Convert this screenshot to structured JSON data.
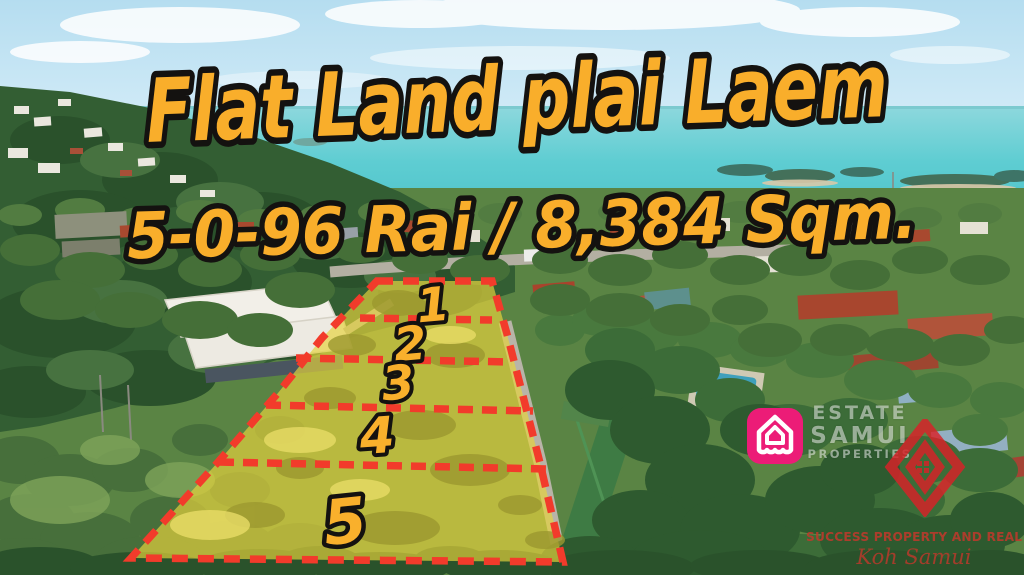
{
  "banner": {
    "title": "Flat Land plai Laem",
    "subtitle": "5-0-96 Rai / 8,384 Sqm."
  },
  "plots": [
    {
      "label": "1"
    },
    {
      "label": "2"
    },
    {
      "label": "3"
    },
    {
      "label": "4"
    },
    {
      "label": "5"
    }
  ],
  "watermark": {
    "line1": "ESTATE",
    "line2": "SAMUI",
    "line3": "PROPERTIES"
  },
  "agency": {
    "name": "SUCCESS PROPERTY AND REAL ESTATE",
    "location": "Koh Samui"
  },
  "icons": {
    "estate_samui_logo": "house-icon",
    "success_logo": "diamond-icon"
  },
  "colors": {
    "headline_yellow": "#f9ae2b",
    "outline_black": "#141210",
    "boundary_red": "#f23b2b",
    "plot_fill_yellow": "#e6d33c",
    "estate_samui_pink": "#ec1c77",
    "success_logo_red": "#da2128",
    "agency_text_red": "#be3a2c",
    "sea_turquoise": "#4fc3c9"
  }
}
